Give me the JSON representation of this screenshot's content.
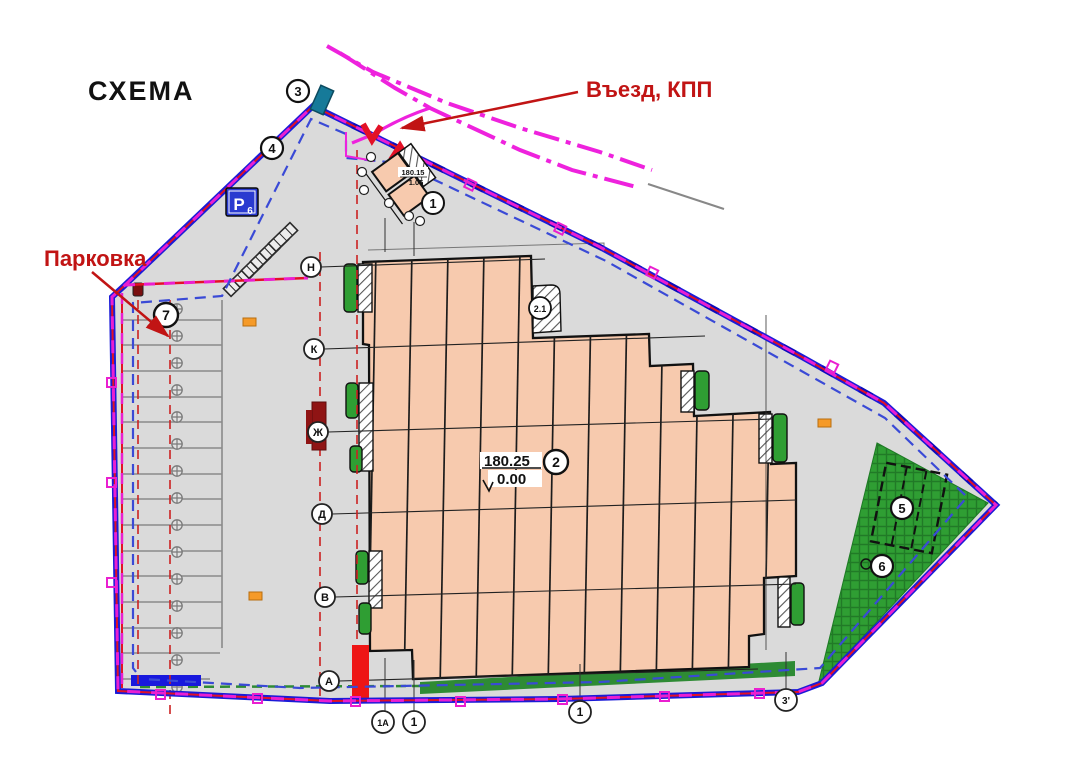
{
  "title": "СХЕМА",
  "annotations": {
    "entrance": {
      "label": "Въезд, КПП"
    },
    "parking": {
      "label": "Парковка"
    }
  },
  "building": {
    "number": "2",
    "elevation_abs": "180.25",
    "elevation_rel": "0.00",
    "notch_number": "2.1"
  },
  "checkpoint": {
    "number": "1",
    "elevation_abs": "180.15",
    "elevation_rel": "1.05"
  },
  "site_markers": {
    "m3": "3",
    "m4": "4",
    "m5": "5",
    "m6": "6",
    "m7": "7"
  },
  "parking_sign": {
    "letter": "Р",
    "index": "6"
  },
  "axes": {
    "rows": [
      "Н",
      "К",
      "Ж",
      "Д",
      "В",
      "А"
    ],
    "cols": [
      "1А",
      "1",
      "1",
      "3'"
    ]
  },
  "colors": {
    "boundary_blue": "#1b1bd8",
    "boundary_red": "#e31126",
    "boundary_magenta": "#ea1fd0",
    "inner_dashed_blue": "#3a4ad6",
    "site_fill": "#dadada",
    "building_fill": "#f7caae",
    "green": "#2f9e33",
    "annotation_red": "#c11414",
    "sign_blue": "#2a3bd0"
  }
}
